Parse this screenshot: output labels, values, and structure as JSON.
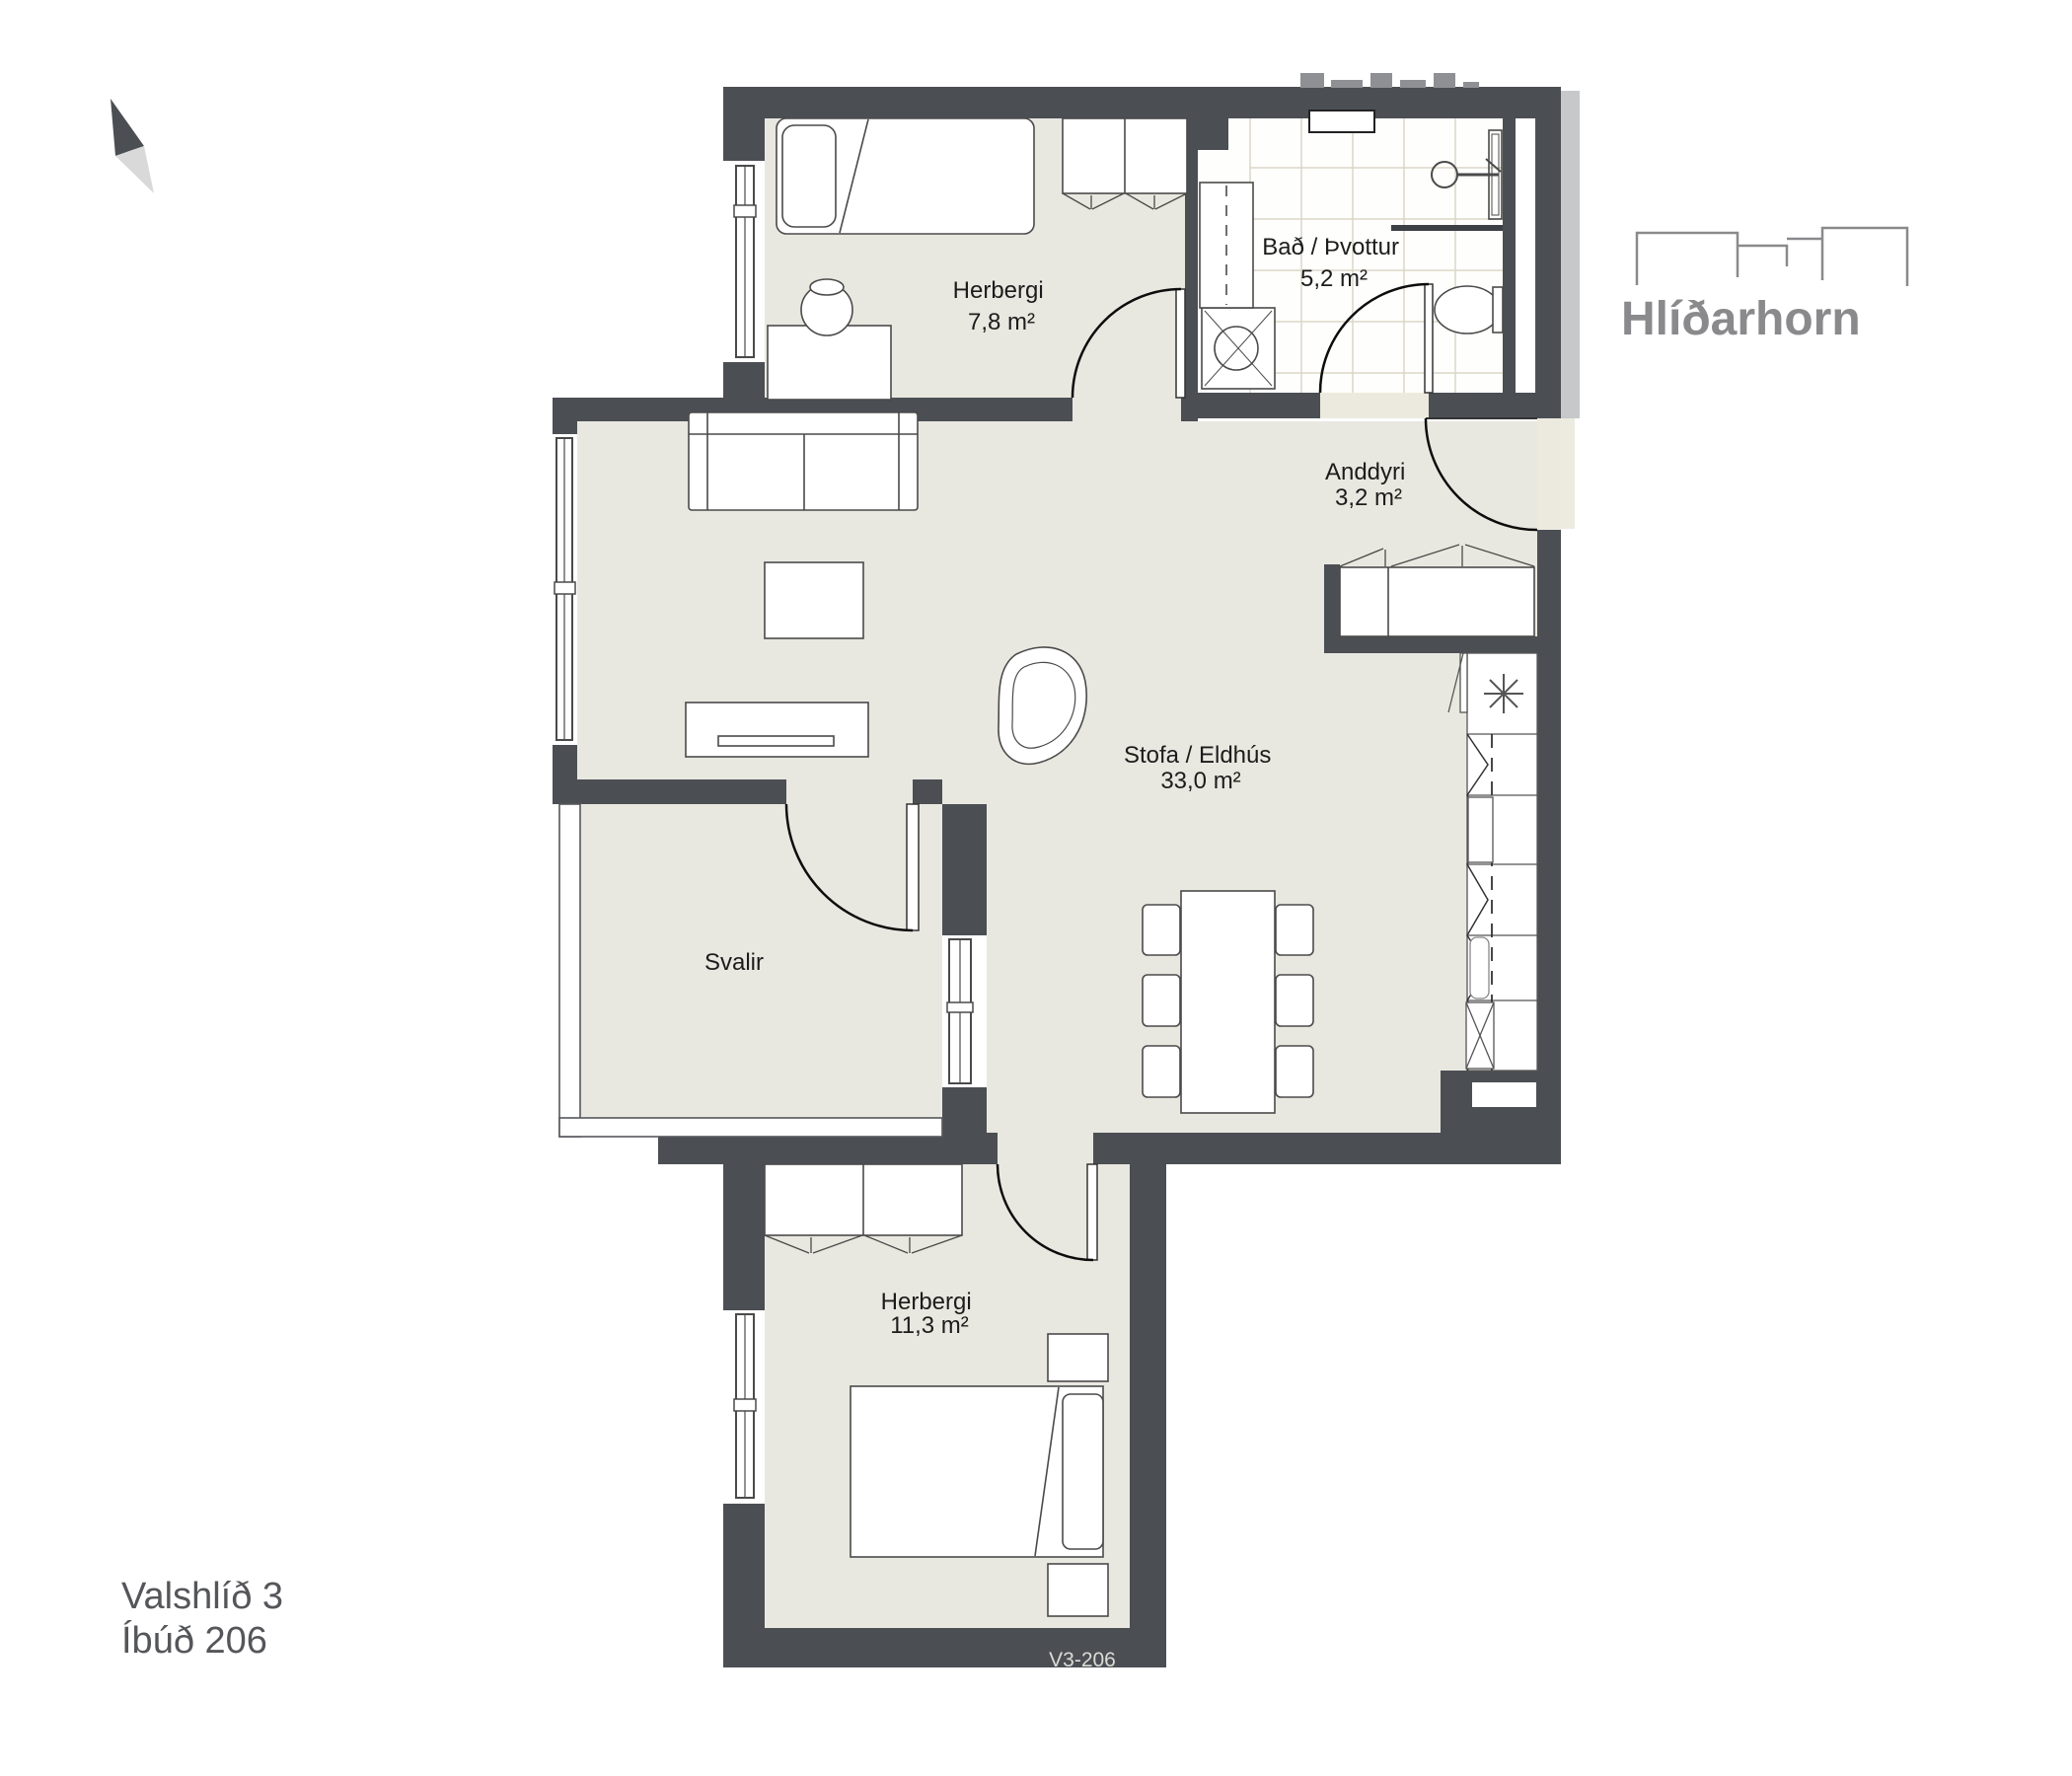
{
  "logo": {
    "name": "Hlíðarhorn"
  },
  "address": {
    "line1": "Valshlíð 3",
    "line2": "Íbúð 206"
  },
  "plan_code": "V3-206",
  "rooms": [
    {
      "id": "herbergi-1",
      "label": "Herbergi",
      "area": "7,8 m²"
    },
    {
      "id": "bad-thvottur",
      "label": "Bað / Þvottur",
      "area": "5,2 m²"
    },
    {
      "id": "anddyri",
      "label": "Anddyri",
      "area": "3,2 m²"
    },
    {
      "id": "stofa-eldhus",
      "label": "Stofa / Eldhús",
      "area": "33,0 m²"
    },
    {
      "id": "svalir",
      "label": "Svalir",
      "area": ""
    },
    {
      "id": "herbergi-2",
      "label": "Herbergi",
      "area": "11,3 m²"
    }
  ],
  "colors": {
    "wall": "#4b4f54",
    "floor": "#e9e8e0",
    "tile_line": "#dcd6c8",
    "ghost": "#c7c8c9",
    "brand_gray": "#8a8a8d",
    "text_dark": "#1c1c1c"
  }
}
